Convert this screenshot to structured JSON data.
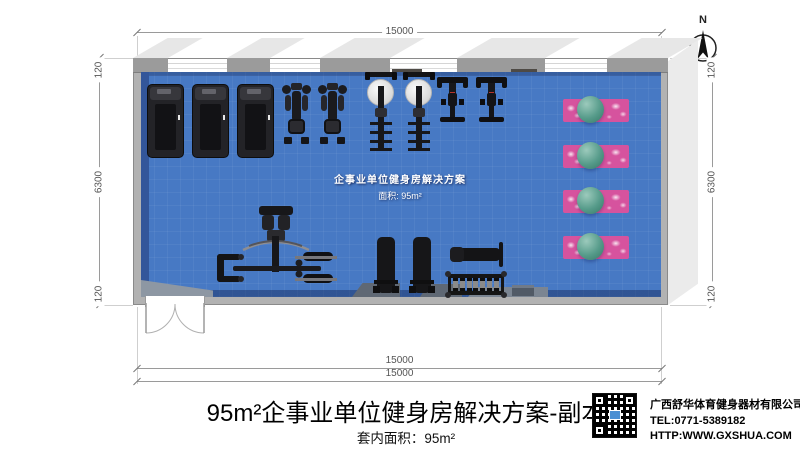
{
  "compass": {
    "label": "N"
  },
  "dimensions": {
    "top_width": "15000",
    "bottom_width_outer": "15000",
    "bottom_width_inner": "15000",
    "left": {
      "top": "120",
      "middle": "6300",
      "bottom": "120"
    },
    "right": {
      "top": "120",
      "middle": "6300",
      "bottom": "120"
    }
  },
  "plan": {
    "watermark_title": "企事业单位健身房解决方案",
    "watermark_area": "面积: 95m²"
  },
  "footer": {
    "title": "95m²企事业单位健身房解决方案-副本",
    "area_label": "套内面积：95m²",
    "company": "广西舒华体育健身器材有限公司",
    "tel": "TEL:0771-5389182",
    "url": "HTTP:WWW.GXSHUA.COM"
  },
  "icons": {
    "north_arrow": "north-compass-icon",
    "treadmill": "treadmill-top-view-icon",
    "exercise_bike": "exercise-bike-top-view-icon",
    "rowing_machine": "rowing-machine-top-view-icon",
    "spin_bike": "spin-bike-top-view-icon",
    "multi_station": "multi-station-trainer-top-view-icon",
    "flat_bench": "flat-bench-top-view-icon",
    "adjustable_bench": "adjustable-bench-top-view-icon",
    "dumbbell_rack": "dumbbell-rack-top-view-icon",
    "yoga_mat_ball": "yoga-mat-with-exercise-ball-icon",
    "qr_code": "qr-code-icon",
    "double_door": "double-swing-door-icon"
  },
  "colors": {
    "floor_blue": "#4779c4",
    "floor_dark_blue": "#33569a",
    "wall_gray": "#b2b2b2",
    "mat_pink": "#d6539e",
    "ball_teal": "#569b8a",
    "accent_red": "#b8352c"
  }
}
